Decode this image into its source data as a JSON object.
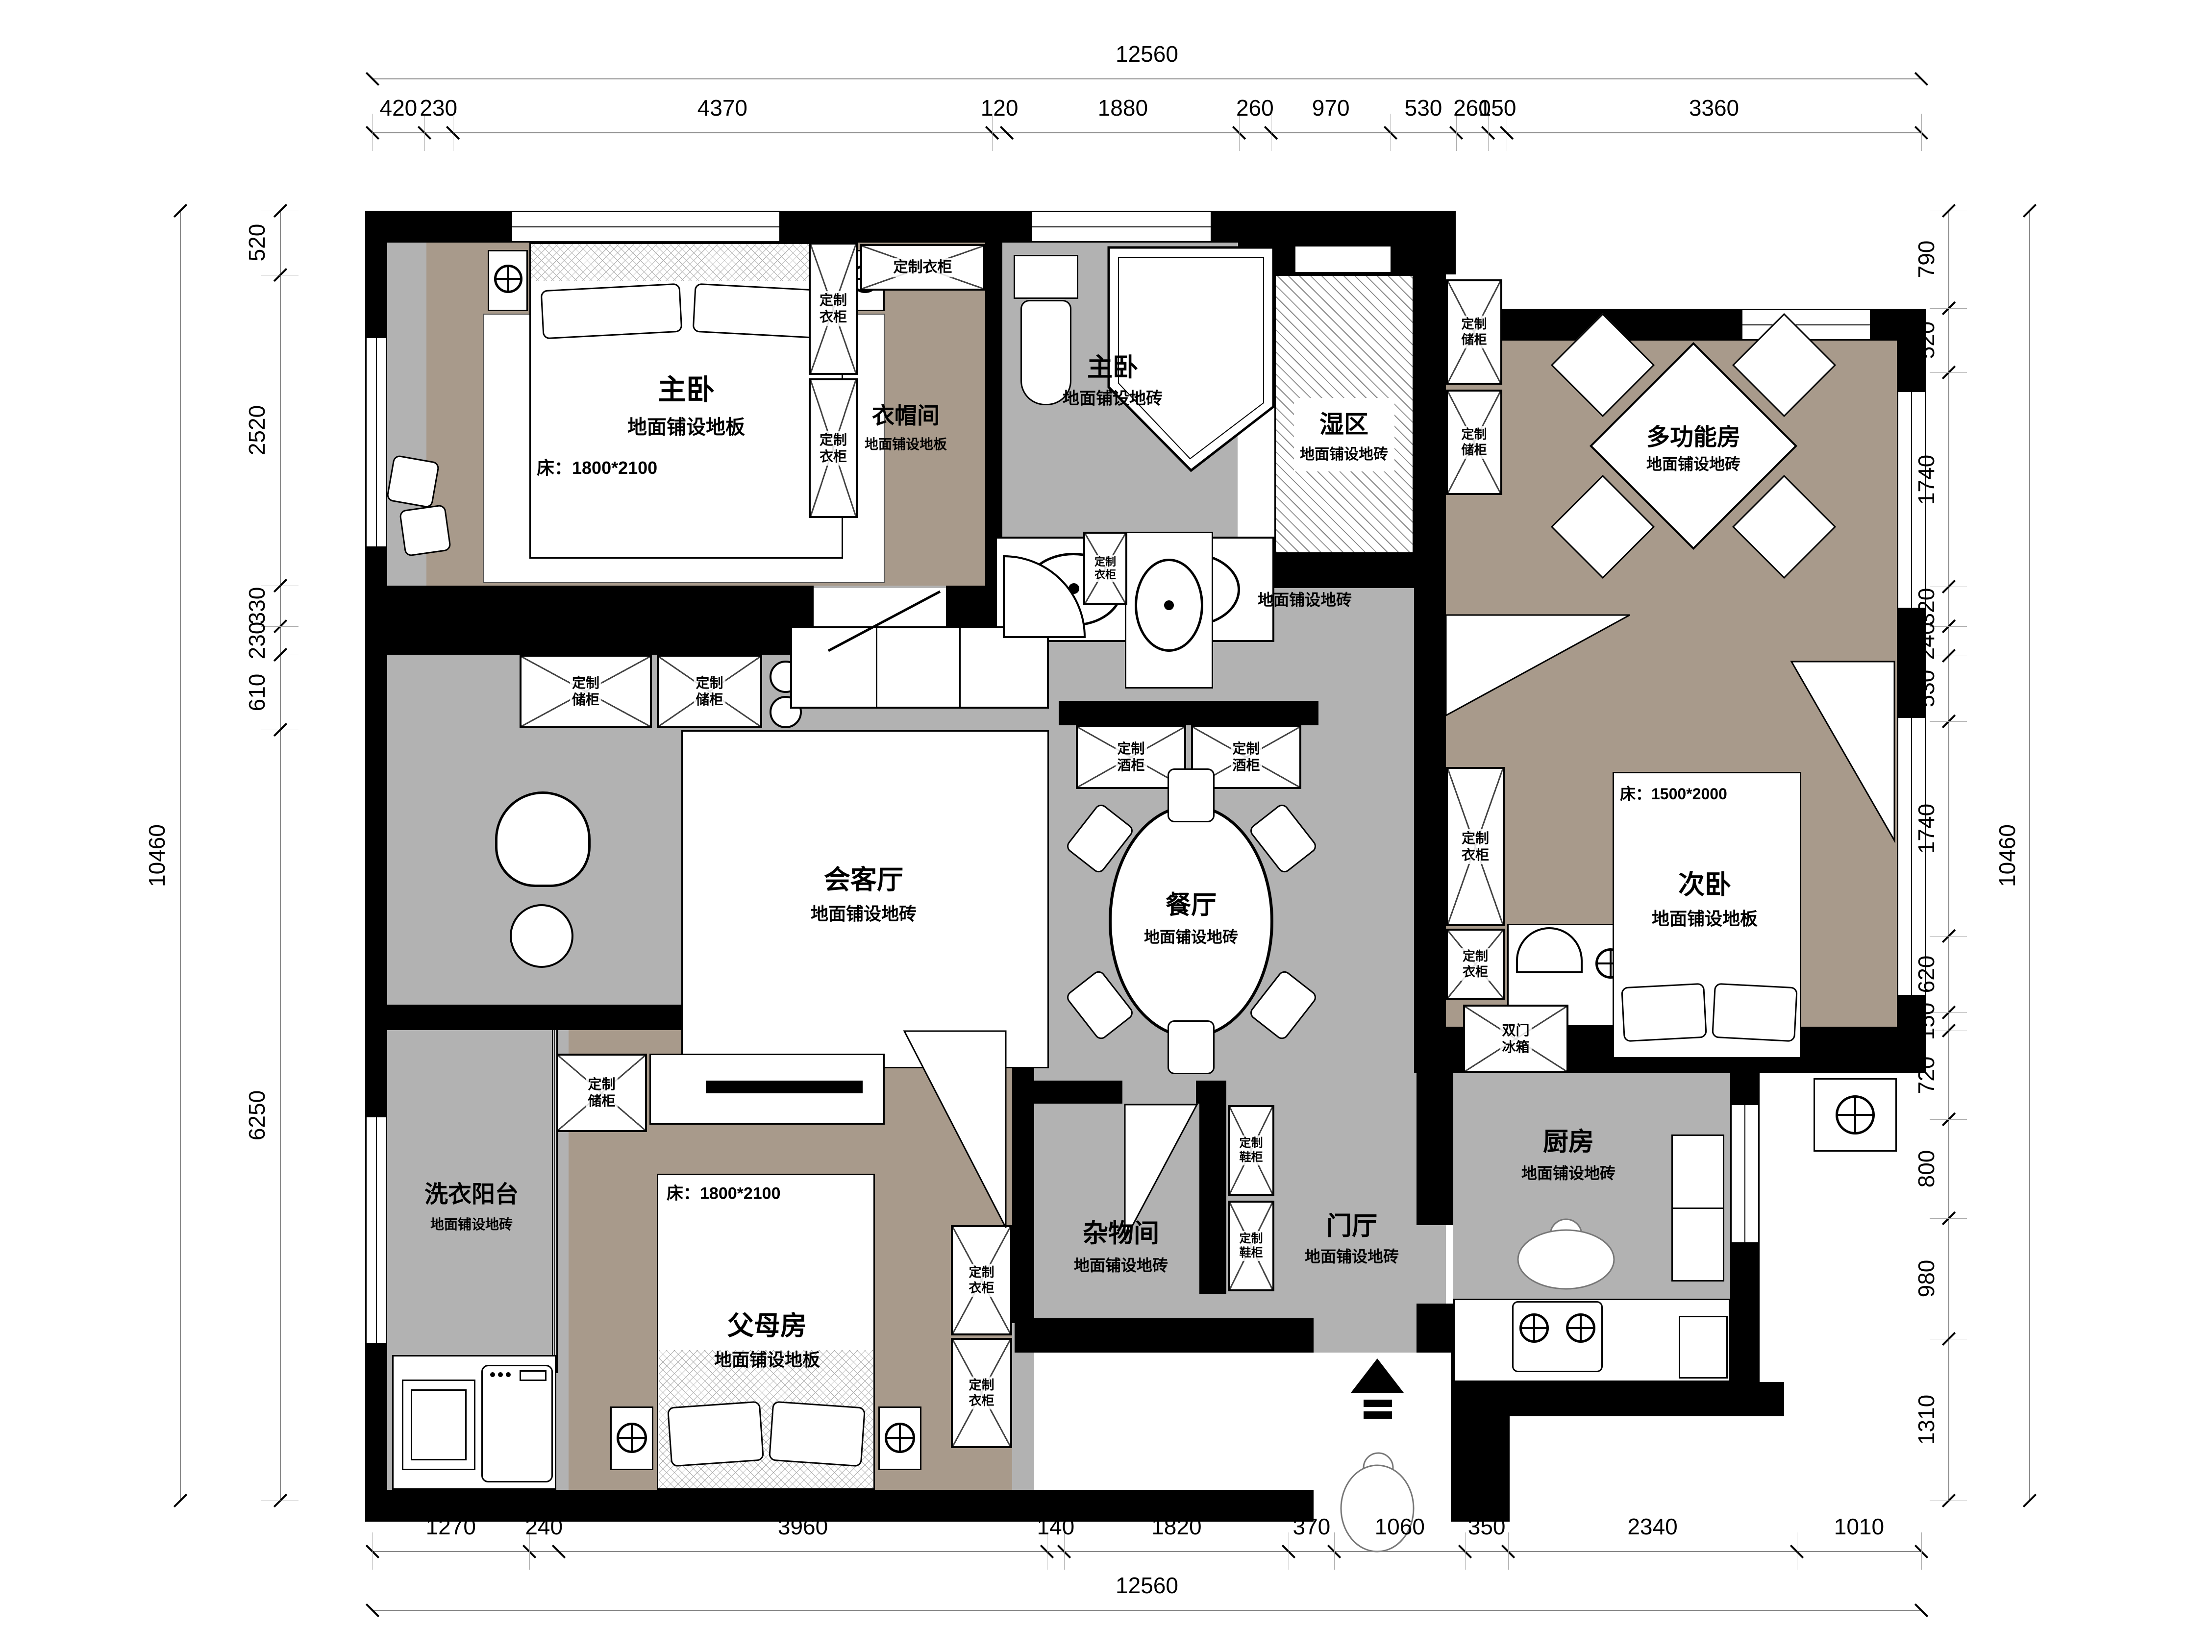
{
  "colors": {
    "wood_floor": "#a89a8b",
    "tile_floor": "#b2b2b2",
    "wall": "#000000",
    "dim_line": "#888888"
  },
  "dimensions": {
    "top": {
      "total": "12560",
      "segments": [
        "420",
        "230",
        "4370",
        "120",
        "1880",
        "260",
        "970",
        "530",
        "260",
        "150",
        "3360"
      ]
    },
    "bottom": {
      "total": "12560",
      "segments": [
        "1270",
        "240",
        "3960",
        "140",
        "1820",
        "370",
        "1060",
        "350",
        "2340",
        "1010"
      ]
    },
    "left": {
      "total": "10460",
      "segments": [
        "520",
        "2520",
        "330",
        "230",
        "610",
        "6250"
      ]
    },
    "right": {
      "total": "10460",
      "segments": [
        "790",
        "520",
        "1740",
        "320",
        "240",
        "530",
        "1740",
        "620",
        "150",
        "720",
        "800",
        "980",
        "1310"
      ]
    }
  },
  "rooms": {
    "master_bedroom": {
      "name": "主卧",
      "floor": "地面铺设地板",
      "bed": "床：1800*2100"
    },
    "cloakroom": {
      "name": "衣帽间",
      "floor": "地面铺设地板"
    },
    "master_bath": {
      "name": "主卧",
      "floor": "地面铺设地砖"
    },
    "wet_area": {
      "name": "湿区",
      "floor": "地面铺设地砖"
    },
    "dry_area": {
      "name": "干区",
      "floor": "地面铺设地砖"
    },
    "multi_room": {
      "name": "多功能房",
      "floor": "地面铺设地砖"
    },
    "living_room": {
      "name": "会客厅",
      "floor": "地面铺设地砖"
    },
    "dining_room": {
      "name": "餐厅",
      "floor": "地面铺设地砖"
    },
    "second_bedroom": {
      "name": "次卧",
      "floor": "地面铺设地板",
      "bed": "床：1500*2000"
    },
    "kitchen": {
      "name": "厨房",
      "floor": "地面铺设地砖"
    },
    "foyer": {
      "name": "门厅",
      "floor": "地面铺设地砖"
    },
    "storage_room": {
      "name": "杂物间",
      "floor": "地面铺设地砖"
    },
    "parents_room": {
      "name": "父母房",
      "floor": "地面铺设地板",
      "bed": "床：1800*2100"
    },
    "laundry_balcony": {
      "name": "洗衣阳台",
      "floor": "地面铺设地砖"
    }
  },
  "furniture": {
    "custom_wardrobe": "定制衣柜",
    "custom_storage": "定制储柜",
    "custom_wine_cabinet": "定制酒柜",
    "custom_shoe_cabinet": "定制鞋柜",
    "double_door_fridge": "双门冰箱",
    "finished_desk": "成品书桌"
  }
}
